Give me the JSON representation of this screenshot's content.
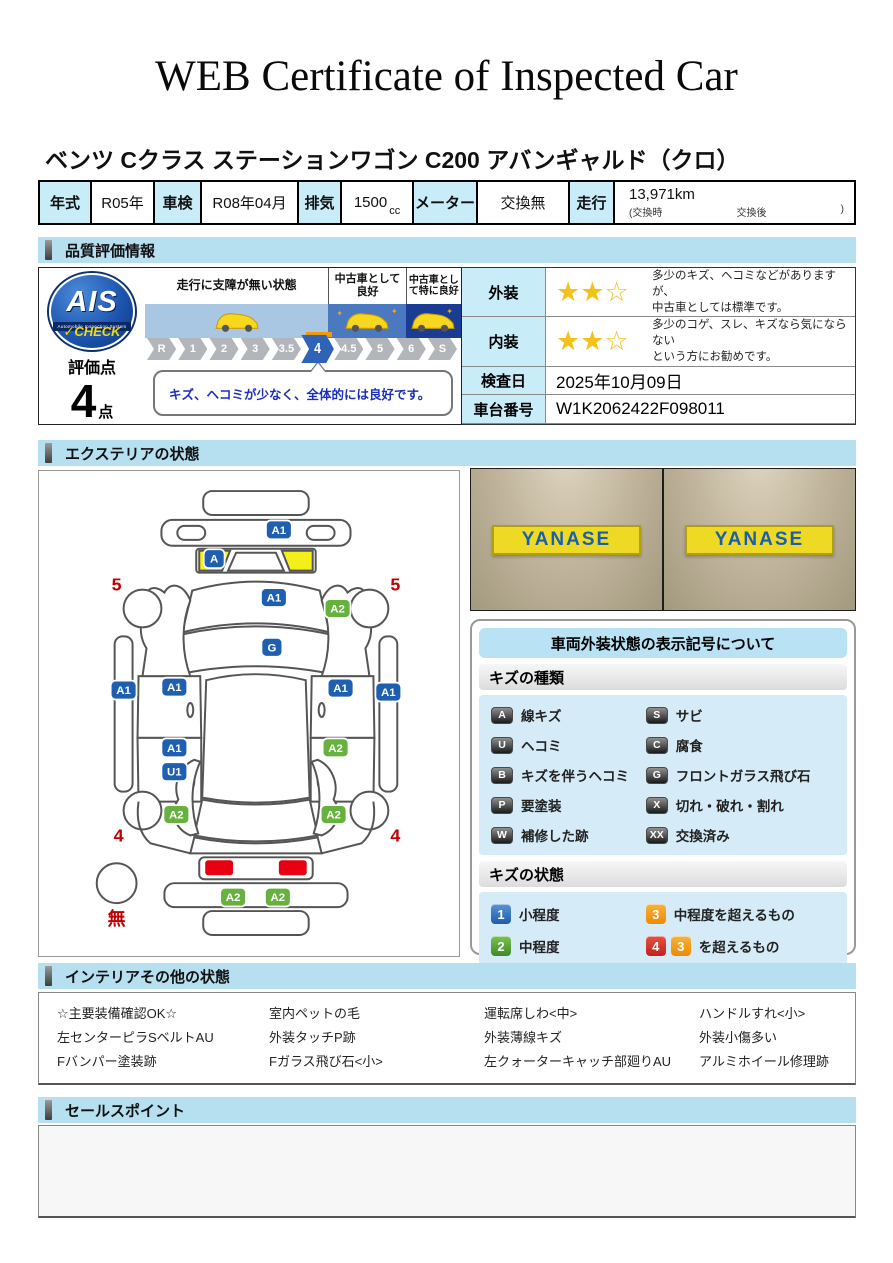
{
  "header": {
    "title": "WEB Certificate of Inspected Car"
  },
  "car_name": "ベンツ Cクラス ステーションワゴン C200 アバンギャルド（クロ）",
  "info": {
    "year_label": "年式",
    "year": "R05年",
    "shaken_label": "車検",
    "shaken": "R08年04月",
    "displacement_label": "排気",
    "displacement": "1500",
    "displacement_unit": "cc",
    "meter_label": "メーター",
    "meter": "交換無",
    "mileage_label": "走行",
    "mileage": "13,971km",
    "mileage_note_open": "(交換時",
    "mileage_note_mid": "交換後",
    "mileage_note_close": ")"
  },
  "sections": {
    "quality": "品質評価情報",
    "exterior": "エクステリアの状態",
    "interior": "インテリアその他の状態",
    "sales": "セールスポイント"
  },
  "quality": {
    "ais": {
      "logo_text": "AIS",
      "logo_sub": "Automobile Inspection System",
      "logo_check": "✓CHECK",
      "score_label": "評価点",
      "score": "4",
      "score_unit": "点"
    },
    "scale": {
      "zones": [
        {
          "label": "走行に支障が無い状態"
        },
        {
          "label": "中古車として良好"
        },
        {
          "label": "中古車として特に良好"
        }
      ],
      "values": [
        "R",
        "1",
        "2",
        "3",
        "3.5",
        "4",
        "4.5",
        "5",
        "6",
        "S"
      ],
      "active": "4",
      "comment": "キズ、ヘコミが少なく、全体的には良好です。"
    },
    "rows": {
      "exterior_label": "外装",
      "exterior_stars": 2,
      "exterior_stars_total": 3,
      "exterior_text1": "多少のキズ、ヘコミなどがありますが、",
      "exterior_text2": "中古車としては標準です。",
      "interior_label": "内装",
      "interior_stars": 2,
      "interior_stars_total": 3,
      "interior_text1": "多少のコゲ、スレ、キズなら気にならない",
      "interior_text2": "という方にお勧めです。",
      "date_label": "検査日",
      "date": "2025年10月09日",
      "vin_label": "車台番号",
      "vin": "W1K2062422F098011"
    }
  },
  "exterior": {
    "photos": [
      {
        "sign": "YANASE"
      },
      {
        "sign": "YANASE"
      }
    ],
    "diagram": {
      "badges": [
        {
          "label": "A1",
          "color": "blue",
          "x": 241,
          "y": 59
        },
        {
          "label": "A",
          "color": "blue",
          "x": 176,
          "y": 88
        },
        {
          "label": "A1",
          "color": "blue",
          "x": 236,
          "y": 127
        },
        {
          "label": "A2",
          "color": "green",
          "x": 300,
          "y": 138
        },
        {
          "label": "G",
          "color": "blue",
          "x": 234,
          "y": 177
        },
        {
          "label": "A1",
          "color": "blue",
          "x": 85,
          "y": 220
        },
        {
          "label": "A1",
          "color": "blue",
          "x": 136,
          "y": 217
        },
        {
          "label": "A1",
          "color": "blue",
          "x": 303,
          "y": 218
        },
        {
          "label": "A1",
          "color": "blue",
          "x": 351,
          "y": 222
        },
        {
          "label": "A1",
          "color": "blue",
          "x": 136,
          "y": 278
        },
        {
          "label": "U1",
          "color": "blue",
          "x": 136,
          "y": 302
        },
        {
          "label": "A2",
          "color": "green",
          "x": 298,
          "y": 278
        },
        {
          "label": "A2",
          "color": "green",
          "x": 138,
          "y": 345
        },
        {
          "label": "A2",
          "color": "green",
          "x": 296,
          "y": 345
        },
        {
          "label": "A2",
          "color": "green",
          "x": 195,
          "y": 428
        },
        {
          "label": "A2",
          "color": "green",
          "x": 240,
          "y": 428
        }
      ],
      "marks": [
        {
          "text": "5",
          "x": 78,
          "y": 120
        },
        {
          "text": "5",
          "x": 358,
          "y": 120
        },
        {
          "text": "4",
          "x": 80,
          "y": 372
        },
        {
          "text": "4",
          "x": 358,
          "y": 372
        },
        {
          "text": "無",
          "x": 78,
          "y": 456
        }
      ]
    },
    "legend": {
      "title": "車両外装状態の表示記号について",
      "kinds_title": "キズの種類",
      "kinds": [
        {
          "code": "A",
          "text": "線キズ"
        },
        {
          "code": "S",
          "text": "サビ"
        },
        {
          "code": "U",
          "text": "ヘコミ"
        },
        {
          "code": "C",
          "text": "腐食"
        },
        {
          "code": "B",
          "text": "キズを伴うヘコミ"
        },
        {
          "code": "G",
          "text": "フロントガラス飛び石"
        },
        {
          "code": "P",
          "text": "要塗装"
        },
        {
          "code": "X",
          "text": "切れ・破れ・割れ"
        },
        {
          "code": "W",
          "text": "補修した跡"
        },
        {
          "code": "XX",
          "text": "交換済み"
        }
      ],
      "states_title": "キズの状態",
      "states": [
        {
          "badges": [
            {
              "n": "1",
              "color": "blue"
            }
          ],
          "text": "小程度"
        },
        {
          "badges": [
            {
              "n": "3",
              "color": "orange"
            }
          ],
          "text": "中程度を超えるもの"
        },
        {
          "badges": [
            {
              "n": "2",
              "color": "green"
            }
          ],
          "text": "中程度"
        },
        {
          "badges": [
            {
              "n": "4",
              "color": "red"
            },
            {
              "n": "3",
              "color": "orange"
            }
          ],
          "text": "を超えるもの"
        }
      ]
    }
  },
  "interior_status": {
    "columns": [
      [
        "☆主要装備確認OK☆",
        "左センターピラSベルトAU",
        "Fバンパー塗装跡"
      ],
      [
        "室内ペットの毛",
        "外装タッチP跡",
        "Fガラス飛び石<小>"
      ],
      [
        "運転席しわ<中>",
        "外装薄線キズ",
        "左クォーターキャッチ部廻りAU"
      ],
      [
        "ハンドルすれ<小>",
        "外装小傷多い",
        "アルミホイール修理跡"
      ]
    ]
  },
  "colors": {
    "section_header_bg": "#b6dff0",
    "label_cell_bg": "#c9ecf9",
    "badge_blue": "#1e5fb0",
    "badge_green": "#67b13e",
    "highlight_yellow": "#f4ef1a",
    "taillight_red": "#e60012",
    "mark_red": "#c00000",
    "star_gold": "#f3c118",
    "scale_active_blue": "#2f63b8",
    "pointer_orange": "#f59a00"
  }
}
